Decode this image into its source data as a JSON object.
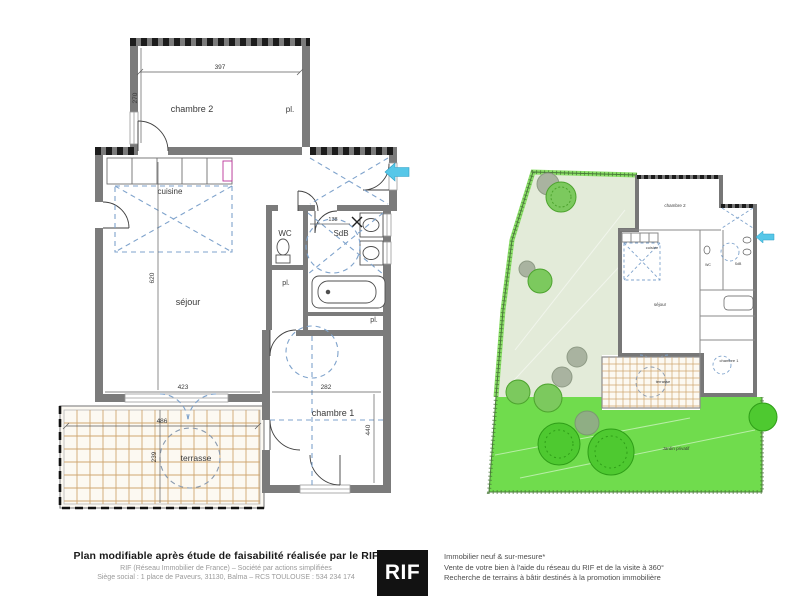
{
  "left_plan": {
    "labels": {
      "chambre2": "chambre 2",
      "closet_chambre2": "pl.",
      "cuisine": "cuisine",
      "wc": "WC",
      "sdb": "SdB",
      "closet_hall": "pl.",
      "closet_sdb": "pl.",
      "sejour": "séjour",
      "chambre1": "chambre 1",
      "terrasse": "terrasse"
    },
    "dimensions": {
      "chambre2_width": "397",
      "chambre2_height": "270",
      "sejour_height": "620",
      "sejour_width": "423",
      "chambre1_width": "282",
      "chambre1_height": "440",
      "terrasse_width": "486",
      "terrasse_height": "239",
      "sdb_width": "138"
    }
  },
  "site_plan": {
    "labels": {
      "chambre2": "chambre 2",
      "cuisine": "cuisine",
      "sejour": "séjour",
      "wc": "WC",
      "sdb": "SdB",
      "chambre1": "chambre 1",
      "terrasse": "terrasse",
      "jardin": "Jardin privatif"
    }
  },
  "footer": {
    "title": "Plan modifiable après étude de faisabilité réalisée par le RIF",
    "company_line": "RIF (Réseau Immobilier de France) – Société par actions simplifiées",
    "address_line": "Siège social : 1 place de Paveurs, 31130, Balma – RCS TOULOUSE : 534 234 174",
    "logo_text": "RIF",
    "services": [
      "Immobilier neuf & sur-mesure*",
      "Vente de votre bien à l'aide du réseau du RIF et de la visite à 360°",
      "Recherche de terrains à bâtir destinés à la promotion immobilière"
    ]
  },
  "colors": {
    "wall": "#7b7b7b",
    "hatch": "#1c1c1c",
    "layout_dash_blue": "#7fa3cc",
    "entry_arrow_cyan": "#56c7e8",
    "terrace_grid": "#cfa670",
    "garden_pale": "#e3ebd9",
    "garden_bright": "#70dc4d",
    "garden_band": "#8ce069",
    "bush_green": "#63cf3e",
    "bush_gray": "#a9b3a0",
    "footer_gray": "#9a9a9a"
  }
}
